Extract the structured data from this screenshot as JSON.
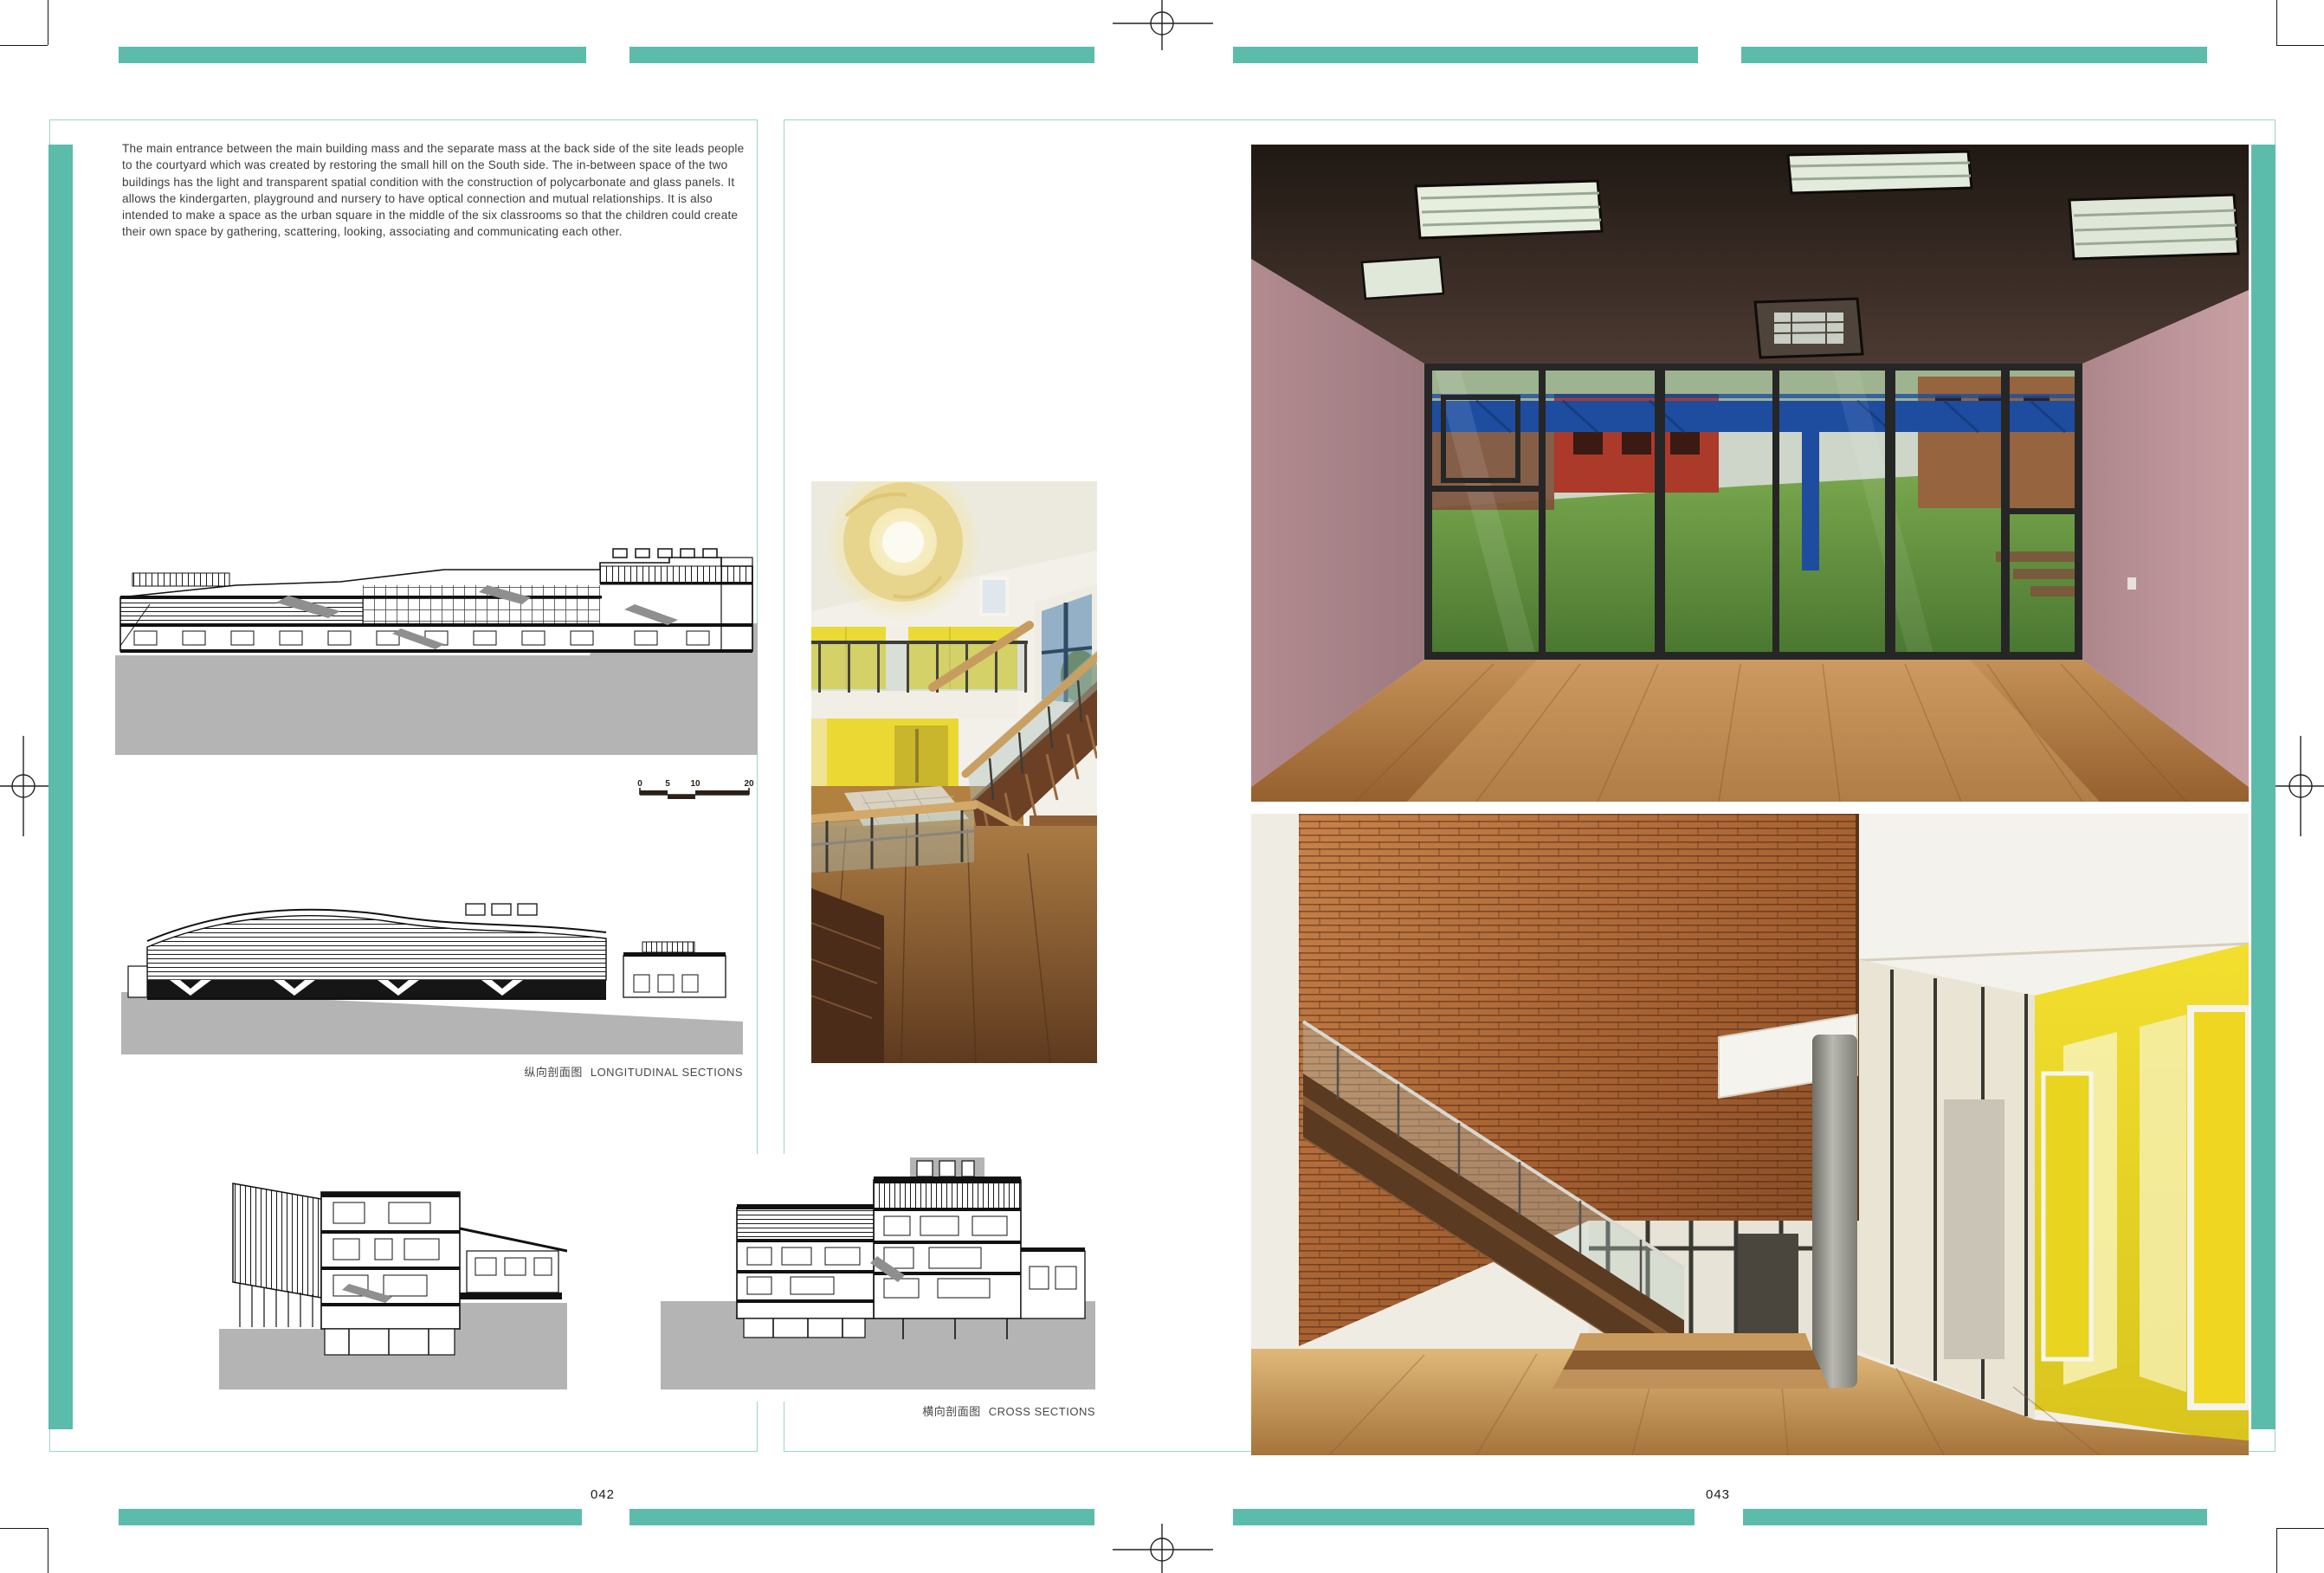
{
  "spread": {
    "left_page_number": "042",
    "right_page_number": "043"
  },
  "left_page": {
    "intro_paragraph": "The main entrance between the main building mass and the separate mass at the back side of the site leads people to the courtyard which was created by restoring the small hill on the South side. The in-between space of the two buildings has the light and transparent spatial condition with the construction of polycarbonate and glass panels. It allows the kindergarten, playground and nursery to have optical connection and mutual relationships. It is also intended to make a space as the urban square in the middle of the six classrooms so that the children could create their own space by gathering, scattering, looking, associating and communicating each other.",
    "caption_longitudinal_zh": "纵向剖面图",
    "caption_longitudinal_en": "LONGITUDINAL SECTIONS",
    "scale_bar_labels": [
      "0",
      "5",
      "10",
      "20"
    ]
  },
  "right_page": {
    "caption_cross_zh": "横向剖面图",
    "caption_cross_en": "CROSS SECTIONS"
  },
  "colors": {
    "accent_teal": "#5cbcab",
    "page_border_teal": "#9ed4c9",
    "drawing_ground_gray": "#b4b4b4"
  }
}
